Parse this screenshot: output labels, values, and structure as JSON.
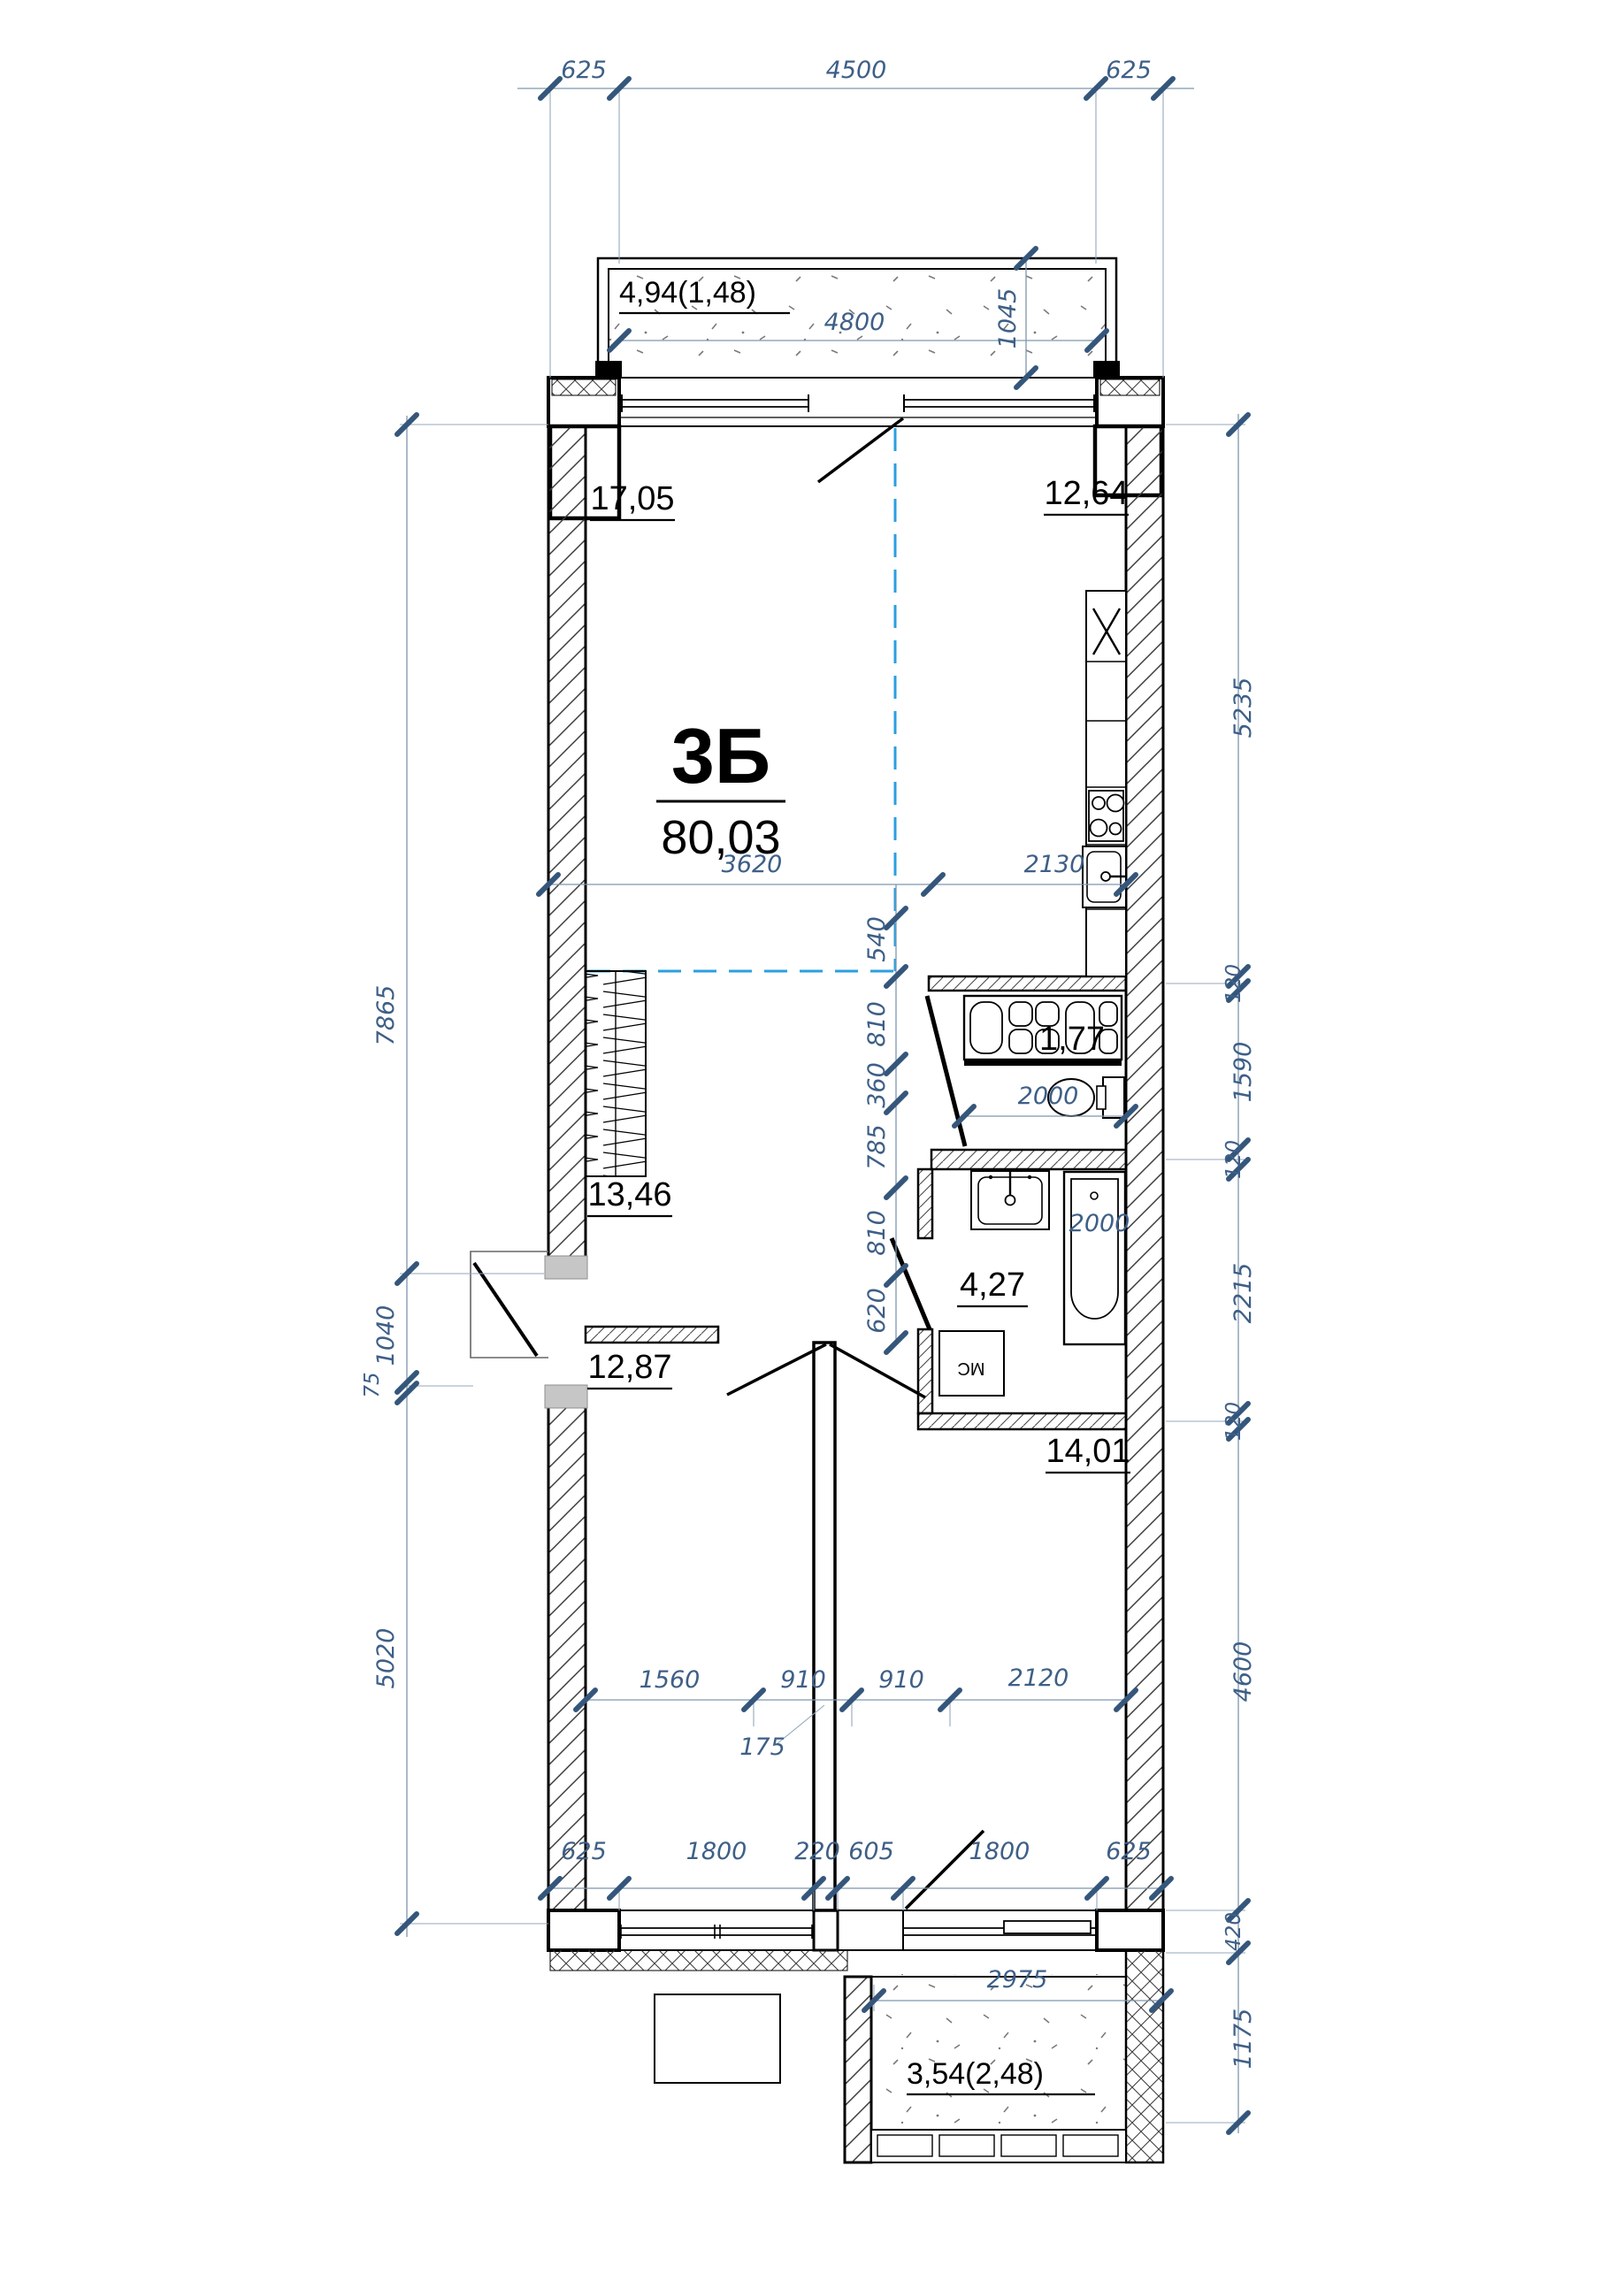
{
  "unit": {
    "code": "3Б",
    "area_total": "80,03"
  },
  "rooms": {
    "living": "17,05",
    "kitchen": "12,64",
    "hallway": "13,46",
    "bedroom1": "12,87",
    "bedroom2": "14,01",
    "bathroom": "4,27",
    "wc": "1,77",
    "balcony_top": "4,94(1,48)",
    "balcony_bottom": "3,54(2,48)"
  },
  "fixtures": {
    "washing_machine": "МС"
  },
  "dims": {
    "top": [
      "625",
      "4500",
      "625"
    ],
    "balcony_top": {
      "width": "4800",
      "depth": "1045"
    },
    "left": [
      "7865",
      "1040",
      "75",
      "5020"
    ],
    "right": [
      "5235",
      "120",
      "1590",
      "120",
      "2215",
      "120",
      "4600",
      "420",
      "1175"
    ],
    "living_width": "3620",
    "kitchen_width": "2130",
    "zone_offset": "540",
    "mid": [
      "810",
      "360",
      "785",
      "810",
      "620"
    ],
    "wc_width": "2000",
    "bath_tub": "2000",
    "rooms_chain": [
      "1560",
      "910",
      "910",
      "2120"
    ],
    "stub": "175",
    "bottom": [
      "625",
      "1800",
      "220",
      "605",
      "1800",
      "625"
    ],
    "balcony_bottom_width": "2975"
  },
  "colors": {
    "dim_text": "#3e5f87",
    "dim_tick": "#35567b",
    "dim_line": "#7e96ad",
    "zone_line": "#2b9fe0",
    "wall": "#000000"
  }
}
